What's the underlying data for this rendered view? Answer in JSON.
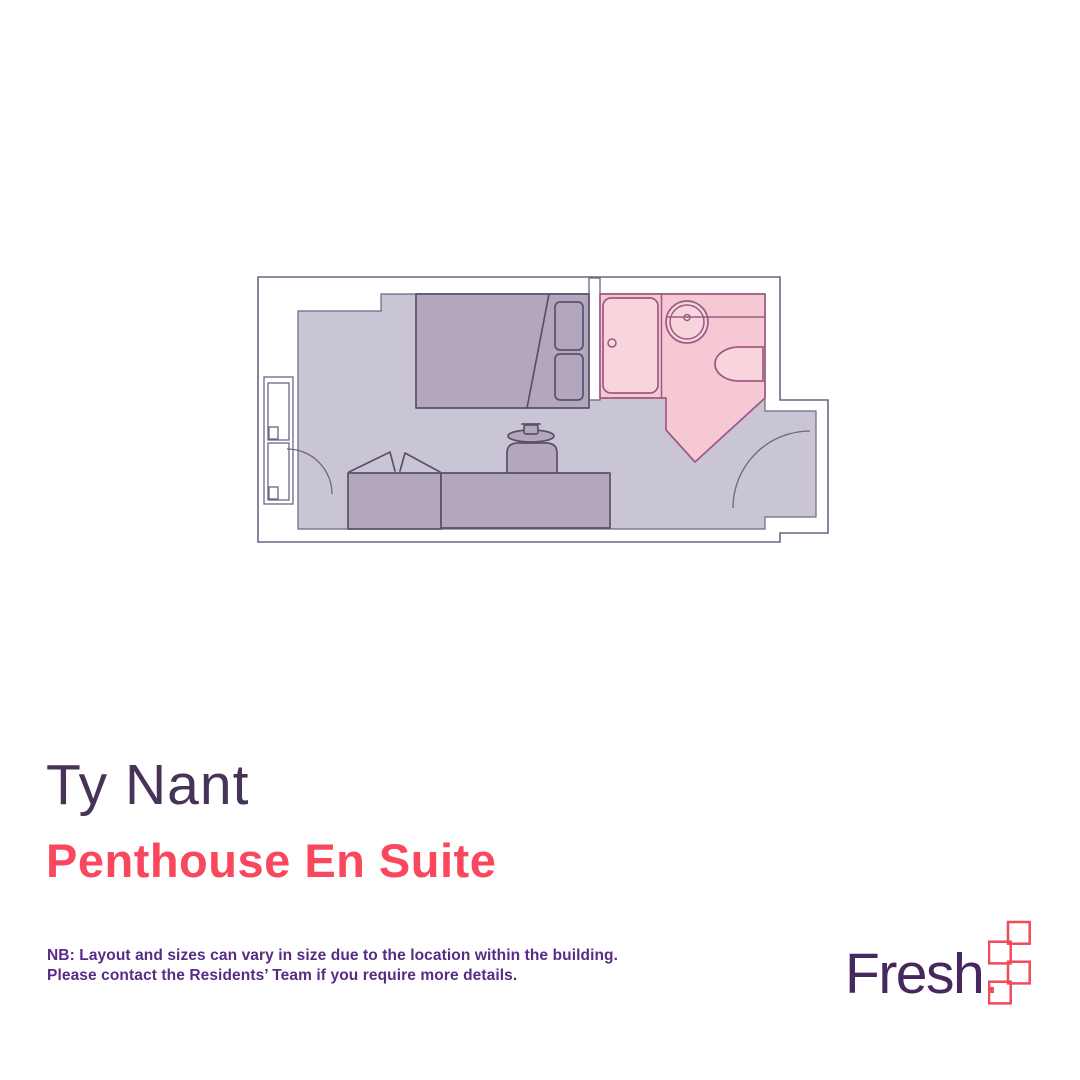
{
  "plan": {
    "title": "Ty Nant",
    "subtitle": "Penthouse En Suite",
    "elements": [
      "bedroom-floor",
      "en-suite-bathroom",
      "bed",
      "duvet",
      "pillows",
      "wardrobe",
      "desk",
      "desk-chair",
      "window",
      "room-door-swing",
      "entry-door-swing",
      "shower",
      "washbasin",
      "toilet"
    ]
  },
  "note": {
    "line1": "NB: Layout and sizes can vary in size due to the location within the building.",
    "line2": "Please contact the Residents’ Team if you require more details."
  },
  "brand": {
    "wordmark": "Fresh",
    "dot": "."
  },
  "colors": {
    "floor": "#c9c5d4",
    "furniture": "#b3a7bd",
    "furniture_outline": "#5a5169",
    "wall_outline": "#6e6486",
    "bathroom_fill": "#f6c8d3",
    "fixture_fill": "#f8d4dd",
    "bathroom_outline": "#9c5a80",
    "title": "#473358",
    "subtitle": "#f9485d",
    "note": "#582b86",
    "logo_text": "#46285f",
    "logo_accent": "#f4485c"
  }
}
